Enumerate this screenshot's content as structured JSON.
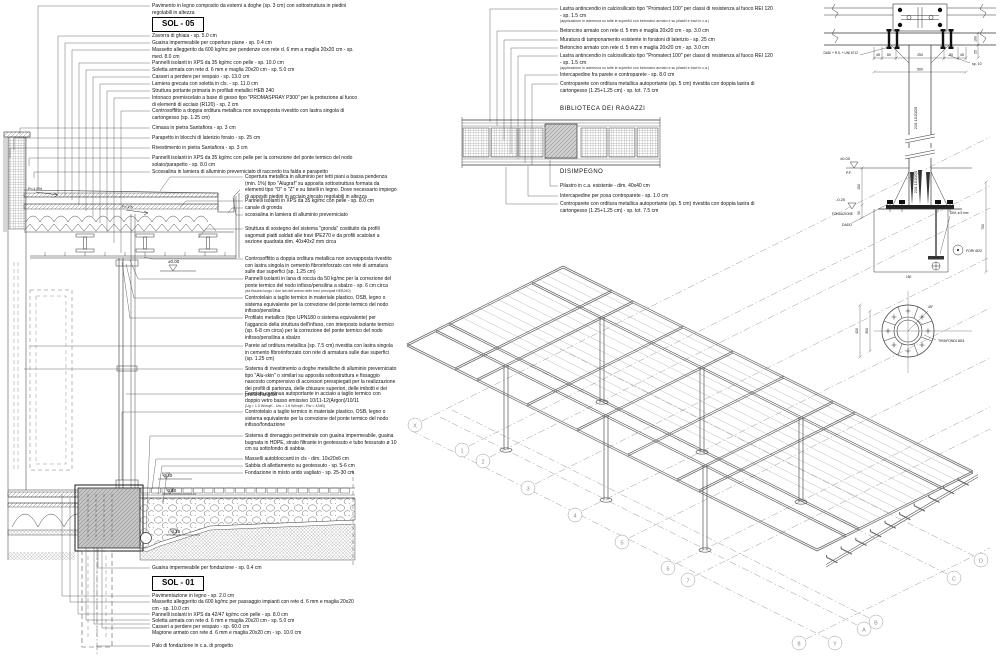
{
  "section": {
    "sol05": {
      "title": "SOL - 05",
      "deck_note": "Pavimento in legno composito da esterni a doghe (sp. 3 cm) con sottostruttura in piedini regolabili in altezza",
      "items": [
        "Zavorra di ghiaia - sp. 5.0 cm",
        "Guaina impermeabile per coperture piane - sp. 0.4 cm",
        "Massetto alleggerito da 600 kg/mc per pendenze con rete d. 6 mm a maglia 20x20 cm - sp. med. 8.0 cm",
        "Pannelli isolanti in XPS da 35 kg/mc con pelle - sp. 10.0 cm",
        "Soletta armata con rete d. 6 mm e maglia 20x20 cm - sp. 5.0 cm",
        "Casseri a perdere per vespaio - sp. 13.0 cm",
        "Lamiera grecata con soletta in cls. - sp. 11.0 cm",
        "Struttura portante primaria in profilati metallici HEB 240",
        "Intonaco premiscelato a base di gesso tipo \"PROMASPRAY P300\" per la protezione al fuoco di elementi di acciaio (R120) - sp. 2 cm",
        "Controsoffitto a doppia orditura metallica non sovrapposta rivestito con lastra singola di cartongesso (sp. 1.25 cm)"
      ]
    },
    "parapet_notes": [
      "Cimasa in pietra Santafiora - sp. 3 cm",
      "Parapetto in blocchi di laterizio forato - sp. 25 cm",
      "Rivestimento in pietra Santafiora - sp. 3 cm",
      "Pannelli isolanti in XPS da 35 kg/mc con pelle per la correzione del ponte termico del nodo solaio/parapetto - sp. 8.0 cm",
      "Scossalina in lamiera di alluminio preverniciato di raccordo tra falda e parapetto"
    ],
    "right_notes": [
      "Copertura metallica in alluminio per tetti piani a bassa pendenza (min. 1%) tipo \"Alugraf\" su apposita sottostruttura formata da elementi tipo \"O\" o \"Z\" e su listelli in legno. Dove necessario impiego di appositi piedini in acciaio zincato regolabili in altezza",
      "Pannelli isolanti in XPS da 35 kg/mc con pelle - sp. 8.0 cm",
      "canale di gronda",
      "scossalina in lamiera di alluminio preverniciato",
      "Struttura di sostegno del sistema \"gronda\" costituito da profili sagomati piatti saldati alle travi IPE270 e da profili scatolari a sezione quadrata dim. 40x40x2 mm circa",
      "Controsoffitto a doppia orditura metallica non sovrapposta rivestito con lastra singola in cemento fibrorinforzato con rete di armatura sulle due superfici (sp. 1.25 cm)",
      "Pannelli isolanti in lana di roccia da 50 kg/mc per la correzione del ponte termico del nodo infisso/pensilina a sbalzo - sp. 6 cm circa",
      "Controtelaio a taglio termico in materiale plastico, OSB, legno o sistema equivalente per la correzione del ponte termico del nodo infisso/pensilina",
      "Profilato metallico (tipo UPN180 o sistema equivalente) per l'aggancio della struttura dell'infisso, con interposto isolante termico (sp. 6-8 cm circa) per la correzione del ponte termico del nodo infisso/pensilina a sbalzo",
      "Parete ad orditura metallica (sp. 7.5 cm) rivestita con lastra singola in cemento fibrorinforzato con rete di armatura sulle due superfici (sp. 1.25 cm)",
      "Sistema di rivestimento a doghe metalliche di alluminio preverniciato tipo \"Alu-skin\" o similari su apposita sottostruttura e fissaggio nascosto comprensivo di accessori presspiegati per la realizzazione dei profili di partenza, delle chiusure superiori, delle imbotti e dei profili d'angolo",
      "Facciata continua autoportante in acciaio a taglio termico con doppio vetro basso emissivo 10/11-12(Argon)/10/11",
      "Controtelaio a taglio termico in materiale plastico, OSB, legno o sistema equivalente per la correzione del ponte termico del nodo infisso/fondazione",
      "Sistema di drenaggio perimetrale con guaina impermeabile, guaina bugnata in HDPE, strato filtrante in geotessuto e tubo fessurato ø 10 cm su sottofondo di sabbia",
      "Masselli autobloccanti in cls - dim. 10x20x6 cm",
      "Sabbia di allettamento su geotessuto - sp. 5-6 cm",
      "Fondazione in misto arido vagliato - sp. 25-30 cm"
    ],
    "sub_lana": "(da fissarsi lungo i due lati dell'anima delle travi principali HEB240)",
    "sub_facciata": "(Ug = 1.0 W/mqK - Uw = 1.6 W/mqK - Rw = 42dB)",
    "sol01": {
      "title": "SOL - 01",
      "pre_note": "Guaina impermeabile per fondazione - sp. 0.4 cm",
      "items": [
        "Pavimentazione in legno - sp. 2.0 cm",
        "Massetto alleggerito da 600 kg/mc per passaggio impianti con rete d. 6 mm e maglia 20x20 cm - sp. 10.0 cm",
        "Pannelli isolanti in XPS da 42/47 kg/mc con pelle - sp. 8.0 cm",
        "Soletta armata con rete d. 6 mm e maglia 20x20 cm - sp. 5.0 cm",
        "Casseri a perdere per vespaio - sp. 60.0 cm",
        "Magrone armato con rete d. 6 mm e maglia 20x20 cm - sp. 10.0 cm"
      ],
      "post_note": "Palo di fondazione in c.a. di progetto"
    },
    "levels": {
      "zero": "±0.00",
      "m340": "-3.40",
      "m360": "-3.60",
      "m425": "-4.25",
      "slope_a": "P=1.5%",
      "slope_b": "P=1%"
    }
  },
  "wall_detail": {
    "notes": [
      "Lastra antincendio in calciosilicato tipo \"Promatect 100\" per classi di resistenza al fuoco REI 120 - sp. 1.5 cm",
      "Betoncino armato con rete d. 5 mm e maglia 20x20 cm - sp. 3.0 cm",
      "Muratura di tamponamento esistente in foratoni di laterizio - sp. 25 cm",
      "Betoncino armato con rete d. 5 mm e maglia 20x20 cm - sp. 3.0 cm",
      "Lastra antincendio in calciosilicato tipo \"Promatect 100\" per classi di resistenza al fuoco REI 120 - sp. 1.5 cm",
      "Intercapedine fra parete e controparete - sp. 8.0 cm",
      "Controparete con orditura metallica autoportante (sp. 5 cm) rivestita con doppia lastra di cartongesso (1.25+1.25 cm) - sp. tot. 7.5 cm"
    ],
    "note_sub": "(applicazione in aderenza su tutte le superfici con betoncino armato e su pilastri e travi in c.a.)",
    "room_upper": "BIBLIOTECA DEI RAGAZZI",
    "room_lower": "DISIMPEGNO",
    "lower_notes": [
      "Pilastro in c.a. esistente - dim. 40x40 cm",
      "Intercapedine per posa controparete - sp. 1.0 cm",
      "Controparete con orditura metallica autoportante (sp. 5 cm) rivestita con doppia lastra di cartongesso (1.25+1.25 cm) - sp. tot. 7.5 cm"
    ]
  },
  "axo": {
    "n": [
      "X",
      "1",
      "2",
      "3",
      "4",
      "5",
      "6",
      "7",
      "8"
    ],
    "l": [
      "Y",
      "A",
      "B",
      "C",
      "D"
    ]
  },
  "column_detail": {
    "labels": {
      "bolts": "DADI + R.S. + UNI 5712",
      "plate_thk": "sp. 10",
      "column": "219.1X20/25",
      "level_zero": "±0.00",
      "level_zero_sub": "P.F.",
      "level_found": "-0.20",
      "level_found_sub": "FONDAZIONE",
      "nut": "DADO",
      "washer": "DIM. ø 5 mm",
      "holes": "FORI Ø22",
      "anchors": "TIRAFONDI Ø24",
      "angle": "45°"
    },
    "dims": {
      "k45": "45",
      "k80": "80",
      "k250": "250",
      "k500": "500",
      "k100": "100",
      "k25": "25",
      "k700": "700",
      "k150": "150",
      "k50": "50",
      "k420": "420",
      "k300": "300"
    }
  }
}
